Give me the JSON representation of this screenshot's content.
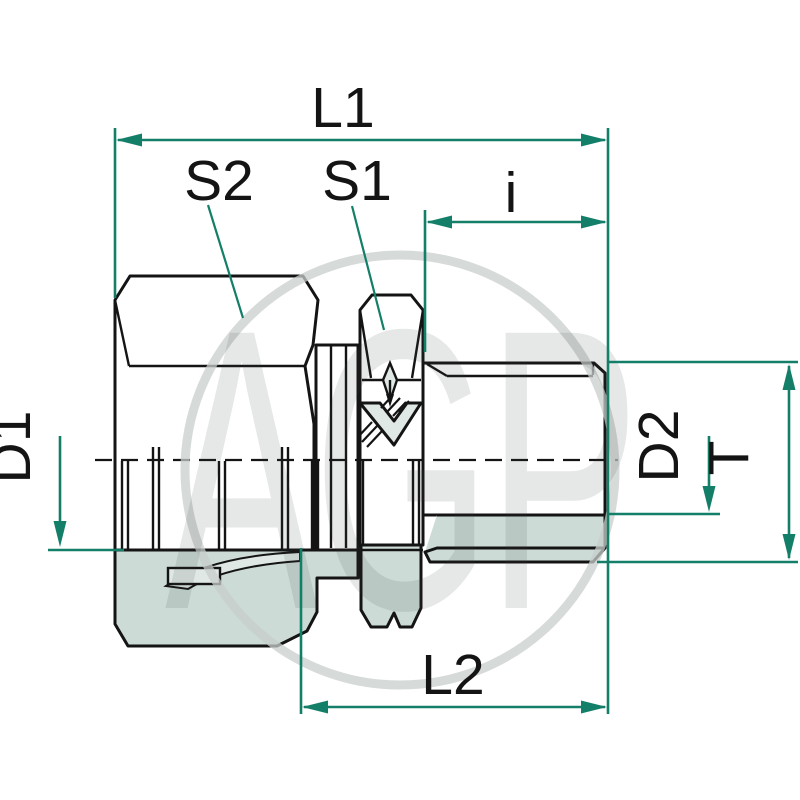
{
  "drawing": {
    "dimension_labels": {
      "l1": "L1",
      "s2": "S2",
      "s1": "S1",
      "i": "i",
      "d1": "D1",
      "d2": "D2",
      "t": "T",
      "l2": "L2"
    },
    "watermark": "AGP",
    "colors": {
      "dimension_teal": "#147f68",
      "body_fill": "#8fb1ac",
      "section_fill": "#ccdbd6",
      "light_part": "#dfe8e4",
      "outline": "#141414",
      "watermark_gray": "#c8cdcb"
    }
  }
}
